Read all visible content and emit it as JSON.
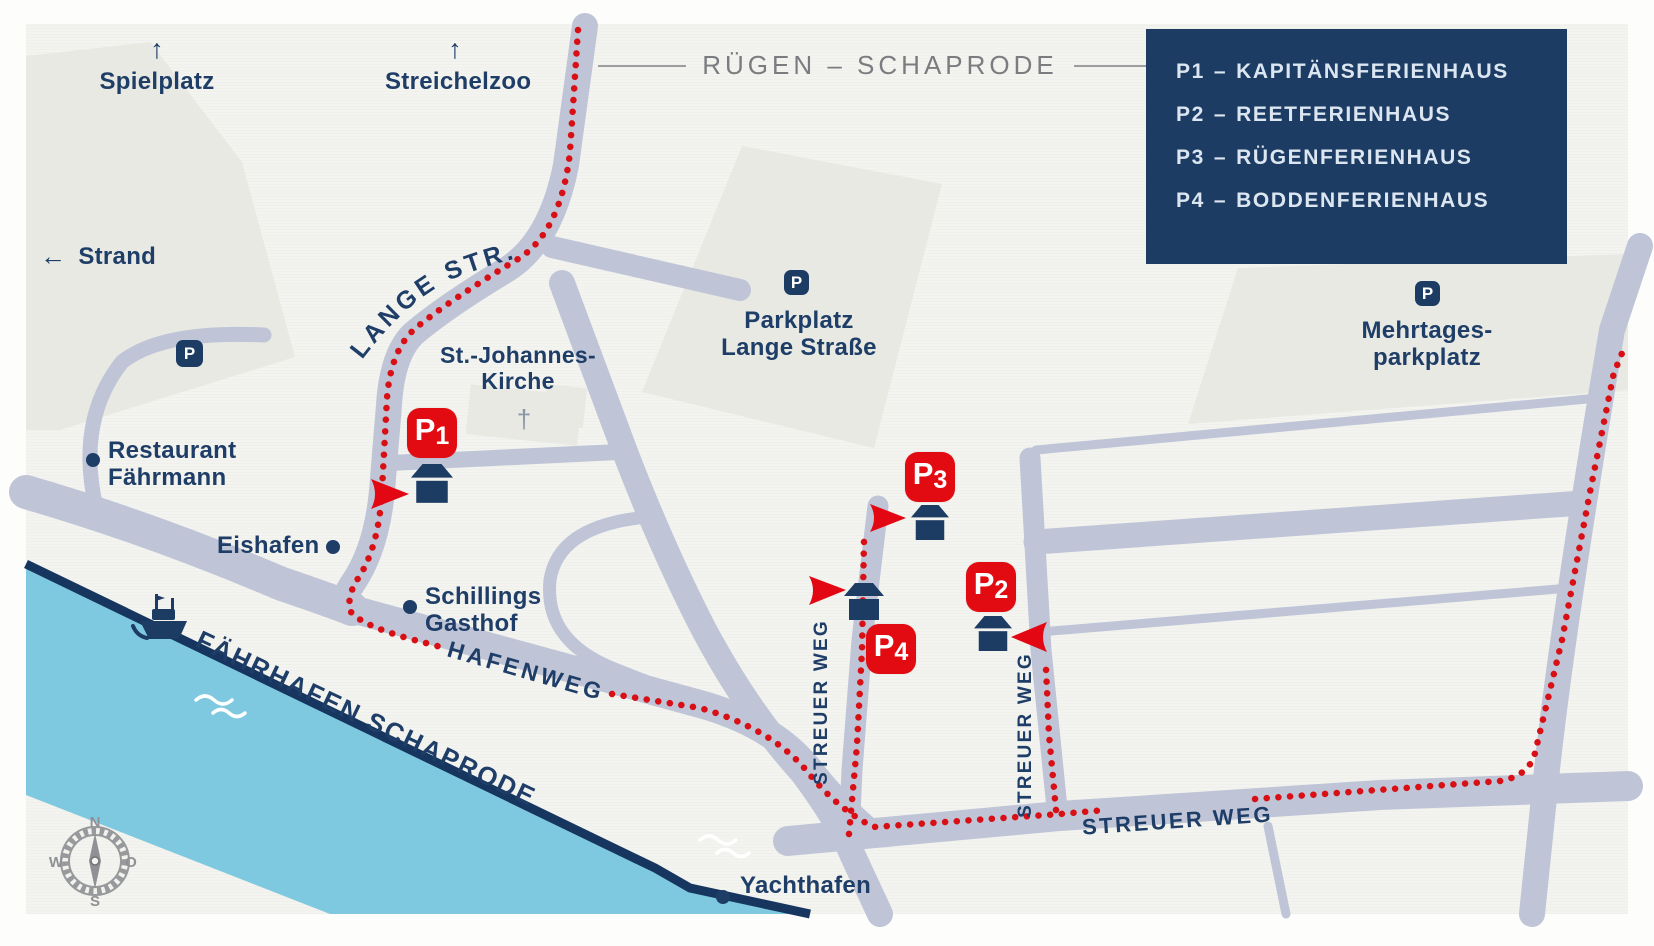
{
  "title": {
    "text": "RÜGEN – SCHAPRODE"
  },
  "legend": {
    "items": [
      {
        "code": "P1",
        "sep": "–",
        "name": "KAPITÄNSFERIENHAUS"
      },
      {
        "code": "P2",
        "sep": "–",
        "name": "REETFERIENHAUS"
      },
      {
        "code": "P3",
        "sep": "–",
        "name": "RÜGENFERIENHAUS"
      },
      {
        "code": "P4",
        "sep": "–",
        "name": "BODDENFERIENHAUS"
      }
    ]
  },
  "streets": {
    "lange": "LANGE STR.",
    "hafenweg": "HAFENWEG",
    "faehrhafen": "FÄHRHAFEN SCHAPRODE",
    "streuer_west": "STREUER WEG",
    "streuer_east": "STREUER WEG",
    "streuer_main": "STREUER WEG"
  },
  "pois": {
    "spielplatz": {
      "label": "Spielplatz",
      "arrow": "↑"
    },
    "streichelzoo": {
      "label": "Streichelzoo",
      "arrow": "↑"
    },
    "strand": {
      "label": "Strand",
      "arrow": "←"
    },
    "restaurant": {
      "line1": "Restaurant",
      "line2": "Fährmann"
    },
    "eishafen": {
      "label": "Eishafen"
    },
    "schillings": {
      "line1": "Schillings",
      "line2": "Gasthof"
    },
    "kirche": {
      "line1": "St.-Johannes-",
      "line2": "Kirche",
      "cross": "†"
    },
    "parkplatz_lange": {
      "line1": "Parkplatz",
      "line2": "Lange Straße",
      "icon": "P"
    },
    "mehrtages": {
      "line1": "Mehrtages-",
      "line2": "parkplatz",
      "icon": "P"
    },
    "yachthafen": {
      "label": "Yachthafen"
    },
    "restaurant_parking": {
      "icon": "P"
    }
  },
  "markers": {
    "p1": {
      "letter": "P",
      "digit": "1"
    },
    "p2": {
      "letter": "P",
      "digit": "2"
    },
    "p3": {
      "letter": "P",
      "digit": "3"
    },
    "p4": {
      "letter": "P",
      "digit": "4"
    }
  },
  "compass": {
    "n": "N",
    "o": "O",
    "s": "S",
    "w": "W"
  },
  "colors": {
    "navy": "#1d3c64",
    "red_marker": "#e30b12",
    "red_route": "#d80f15",
    "road": "#bfc5d7",
    "water": "#7fc9e0",
    "shoreline": "#16365f",
    "paper": "#f3f3ef",
    "block_gray": "#e8e9e3",
    "legend_bg": "#1d3c64",
    "legend_text": "#dce6f1",
    "title_gray": "#7a7c7f",
    "compass_gray": "#97999c"
  }
}
